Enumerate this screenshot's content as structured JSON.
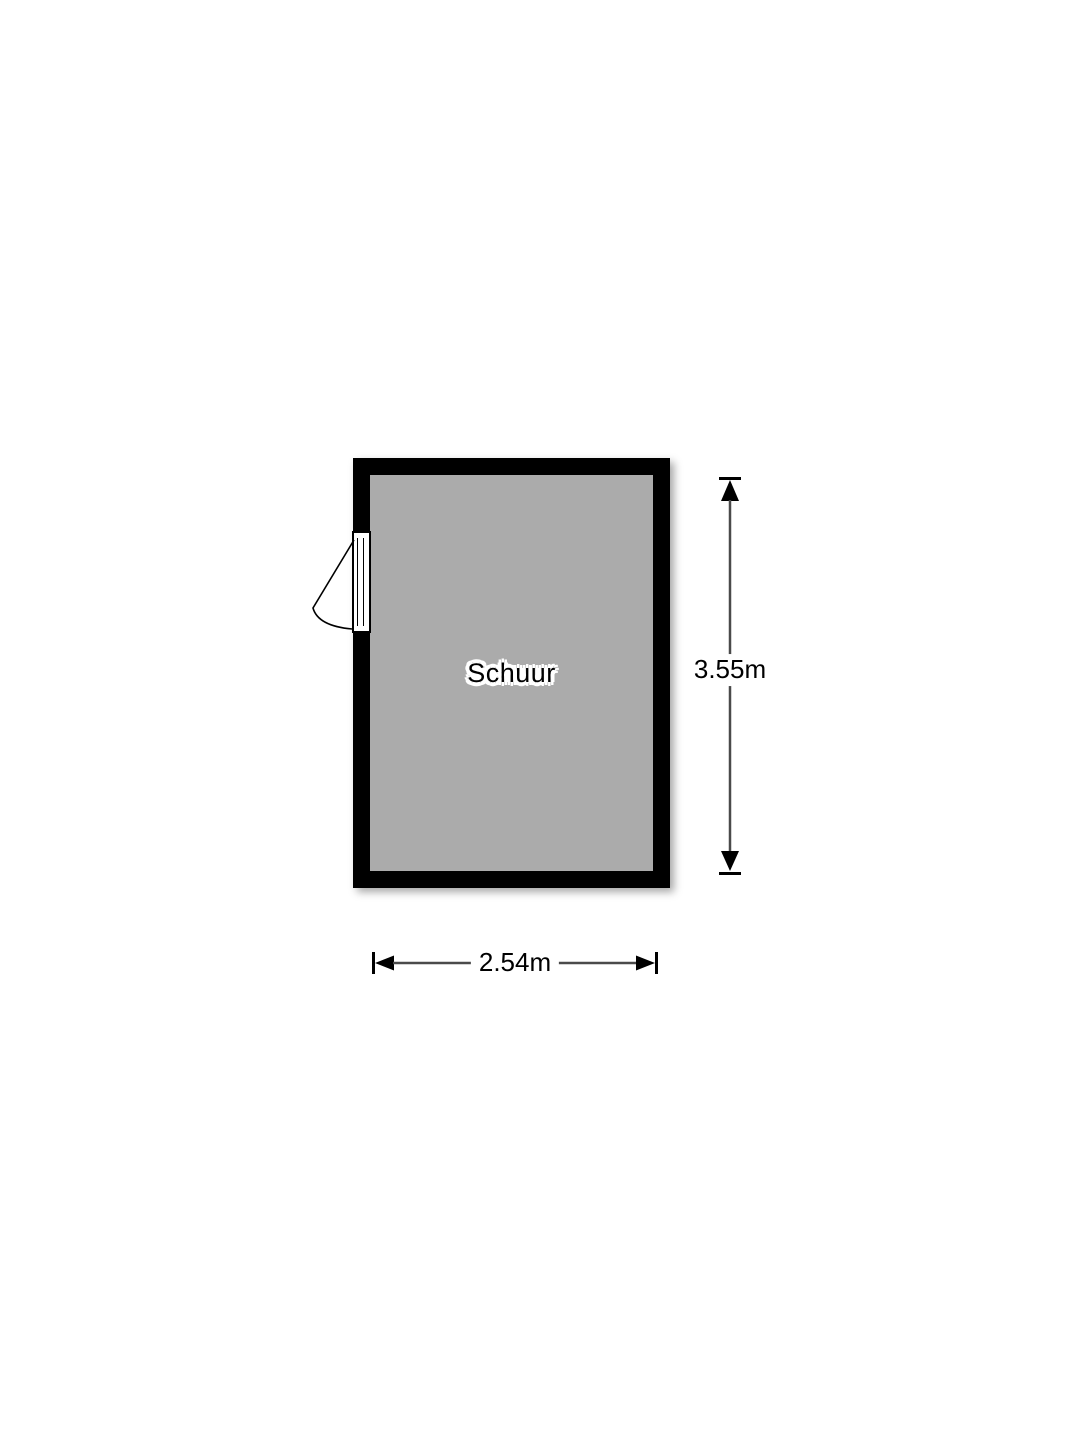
{
  "floorplan": {
    "room": {
      "label": "Schuur"
    },
    "dimensions": {
      "height_label": "3.55m",
      "width_label": "2.54m"
    },
    "icons": {
      "door": "door-swing-icon",
      "arrow_up": "arrow-up-icon",
      "arrow_down": "arrow-down-icon",
      "arrow_left": "arrow-left-icon",
      "arrow_right": "arrow-right-icon"
    },
    "colors": {
      "background": "#ffffff",
      "wall": "#000000",
      "floor": "#ababab",
      "dimension_line": "#4a4a4a",
      "dimension_marker": "#000000",
      "label_text": "#000000",
      "label_halo": "#ffffff",
      "door": "#ffffff",
      "door_outline": "#000000"
    }
  }
}
